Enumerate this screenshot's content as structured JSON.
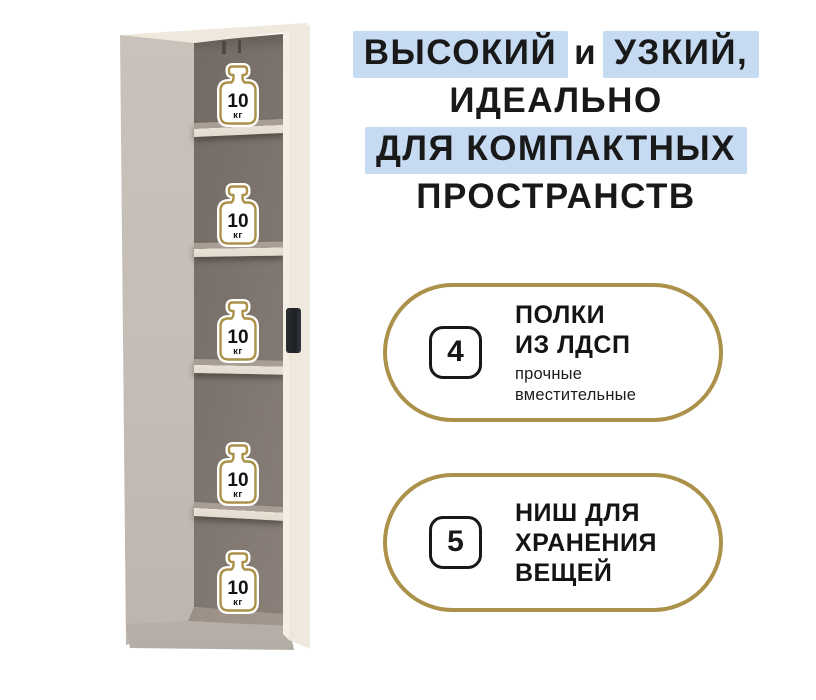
{
  "colors": {
    "gold": "#ab9149",
    "blue": "#c6dbf2",
    "ink": "#191919",
    "side": "#c4bdb5",
    "top_strip": "#efe8dd",
    "door_edge": "#f4eee4",
    "interior_dark": "#6b625c",
    "interior_light": "#8f857e",
    "shelf_top": "#a89e96",
    "shelf_front": "#ebe2d7",
    "handle": "#23262b",
    "floor": "#9b9189",
    "base": "#c3bcb4"
  },
  "cabinet": {
    "weights": [
      {
        "value": "10",
        "unit": "кг"
      },
      {
        "value": "10",
        "unit": "кг"
      },
      {
        "value": "10",
        "unit": "кг"
      },
      {
        "value": "10",
        "unit": "кг"
      },
      {
        "value": "10",
        "unit": "кг"
      }
    ]
  },
  "headline": {
    "l1_hl1": "ВЫСОКИЙ",
    "l1_mid": "и",
    "l1_hl2": "УЗКИЙ,",
    "l2": "ИДЕАЛЬНО",
    "l3": "ДЛЯ КОМПАКТНЫХ",
    "l4": "ПРОСТРАНСТВ"
  },
  "features": [
    {
      "number": "4",
      "title_lines": [
        "ПОЛКИ",
        "ИЗ ЛДСП"
      ],
      "subtitle_lines": [
        "прочные",
        "вместительные"
      ]
    },
    {
      "number": "5",
      "title_lines": [
        "НИШ ДЛЯ",
        "ХРАНЕНИЯ",
        "ВЕЩЕЙ"
      ],
      "subtitle_lines": []
    }
  ]
}
